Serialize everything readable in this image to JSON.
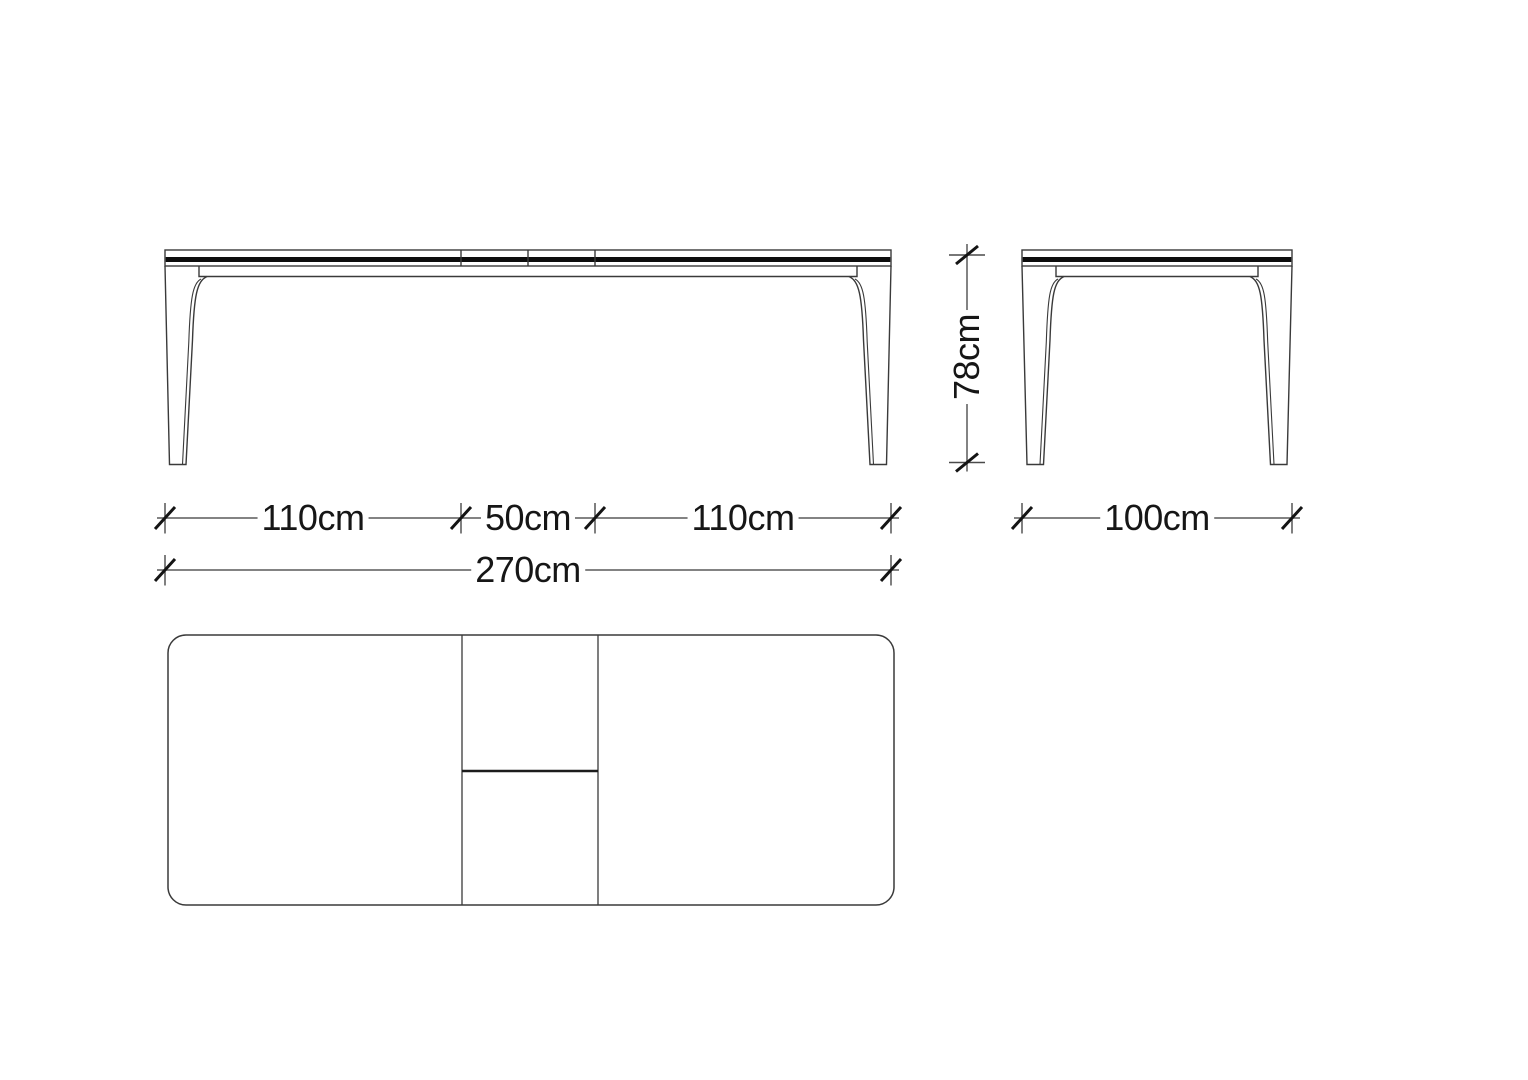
{
  "drawing": {
    "type": "furniture-technical-drawing",
    "subject": "extendable dining table, three orthographic views",
    "colors": {
      "background": "#ffffff",
      "outline": "#3a3a3a",
      "edge_band": "#0d0d0d",
      "dimension_line": "#5a5a5a",
      "tick": "#141414",
      "text": "#161616"
    },
    "dimensions": {
      "front_segments": [
        {
          "label": "110cm"
        },
        {
          "label": "50cm"
        },
        {
          "label": "110cm"
        }
      ],
      "front_total": {
        "label": "270cm"
      },
      "side_width": {
        "label": "100cm"
      },
      "height": {
        "label": "78cm"
      }
    }
  }
}
